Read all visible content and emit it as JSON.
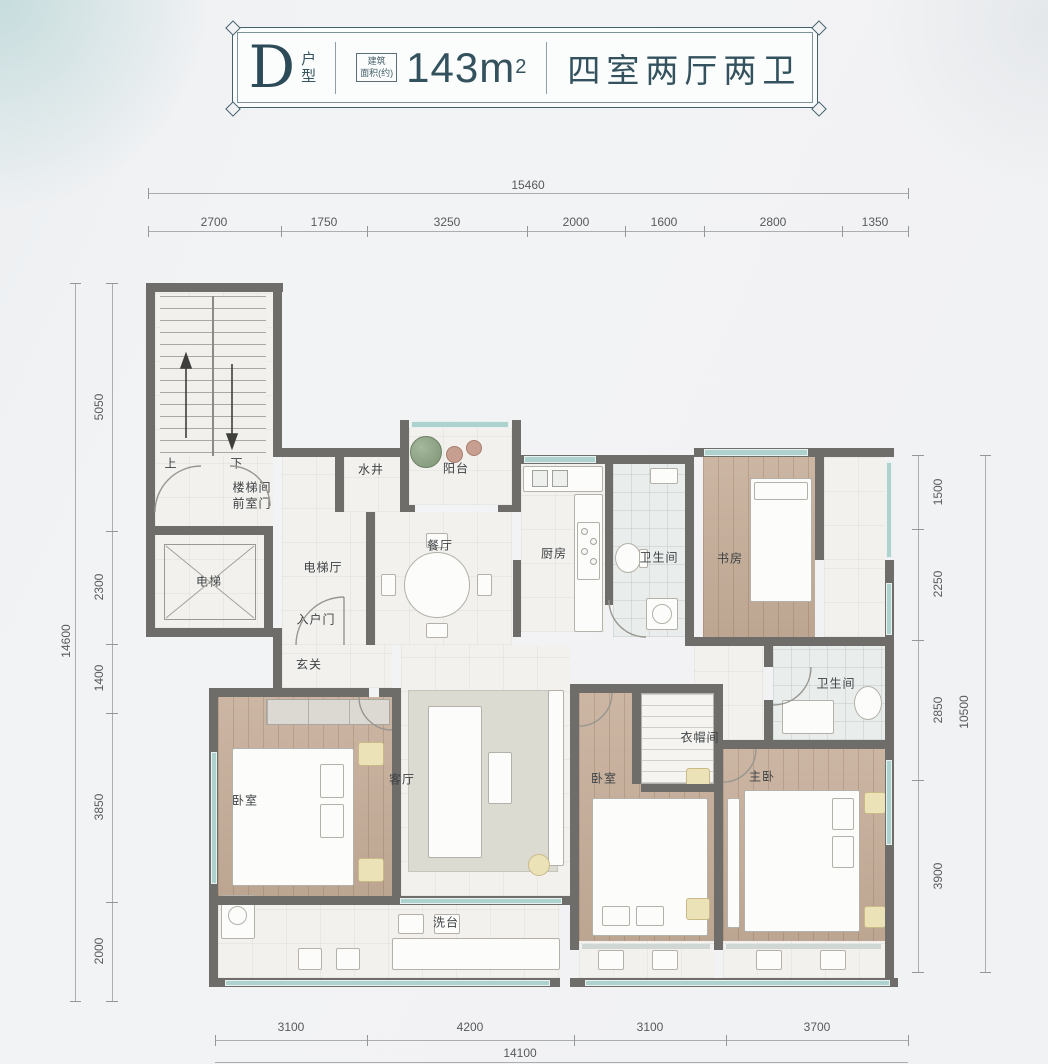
{
  "header": {
    "unit_letter": "D",
    "unit_type_suffix": "户型",
    "area_badge_line1": "建筑",
    "area_badge_line2": "面积(约)",
    "area_value": "143m",
    "area_superscript": "2",
    "layout_summary": "四室两厅两卫"
  },
  "dimensions": {
    "top": {
      "total": "15460",
      "segments": [
        "2700",
        "1750",
        "3250",
        "2000",
        "1600",
        "2800",
        "1350"
      ]
    },
    "left": {
      "total": "14600",
      "segments": [
        "5050",
        "2300",
        "1400",
        "3850",
        "2000"
      ]
    },
    "right": {
      "total": "10500",
      "segments": [
        "1500",
        "2250",
        "2850",
        "3900"
      ]
    },
    "bottom": {
      "total": "14100",
      "segments": [
        "3100",
        "4200",
        "3100",
        "3700"
      ]
    }
  },
  "rooms": {
    "stair_line1": "楼梯间",
    "stair_line2": "前室门",
    "stair_up": "上",
    "stair_down": "下",
    "elevator": "电梯",
    "elevator_hall": "电梯厅",
    "entry_door": "入户门",
    "water_shaft": "水井",
    "balcony": "阳台",
    "dining": "餐厅",
    "kitchen": "厨房",
    "bath1": "卫生间",
    "study": "书房",
    "foyer": "玄关",
    "living": "客厅",
    "bedroom1": "卧室",
    "bedroom2": "卧室",
    "master": "主卧",
    "closet": "衣帽间",
    "bath2": "卫生间",
    "wash_counter": "洗台"
  },
  "colors": {
    "wall": "#6f6d6a",
    "wood_floor": "#c6ae99",
    "window_glass": "#aed2cd",
    "accent": "#33525e",
    "gold": "#ece2b8"
  }
}
